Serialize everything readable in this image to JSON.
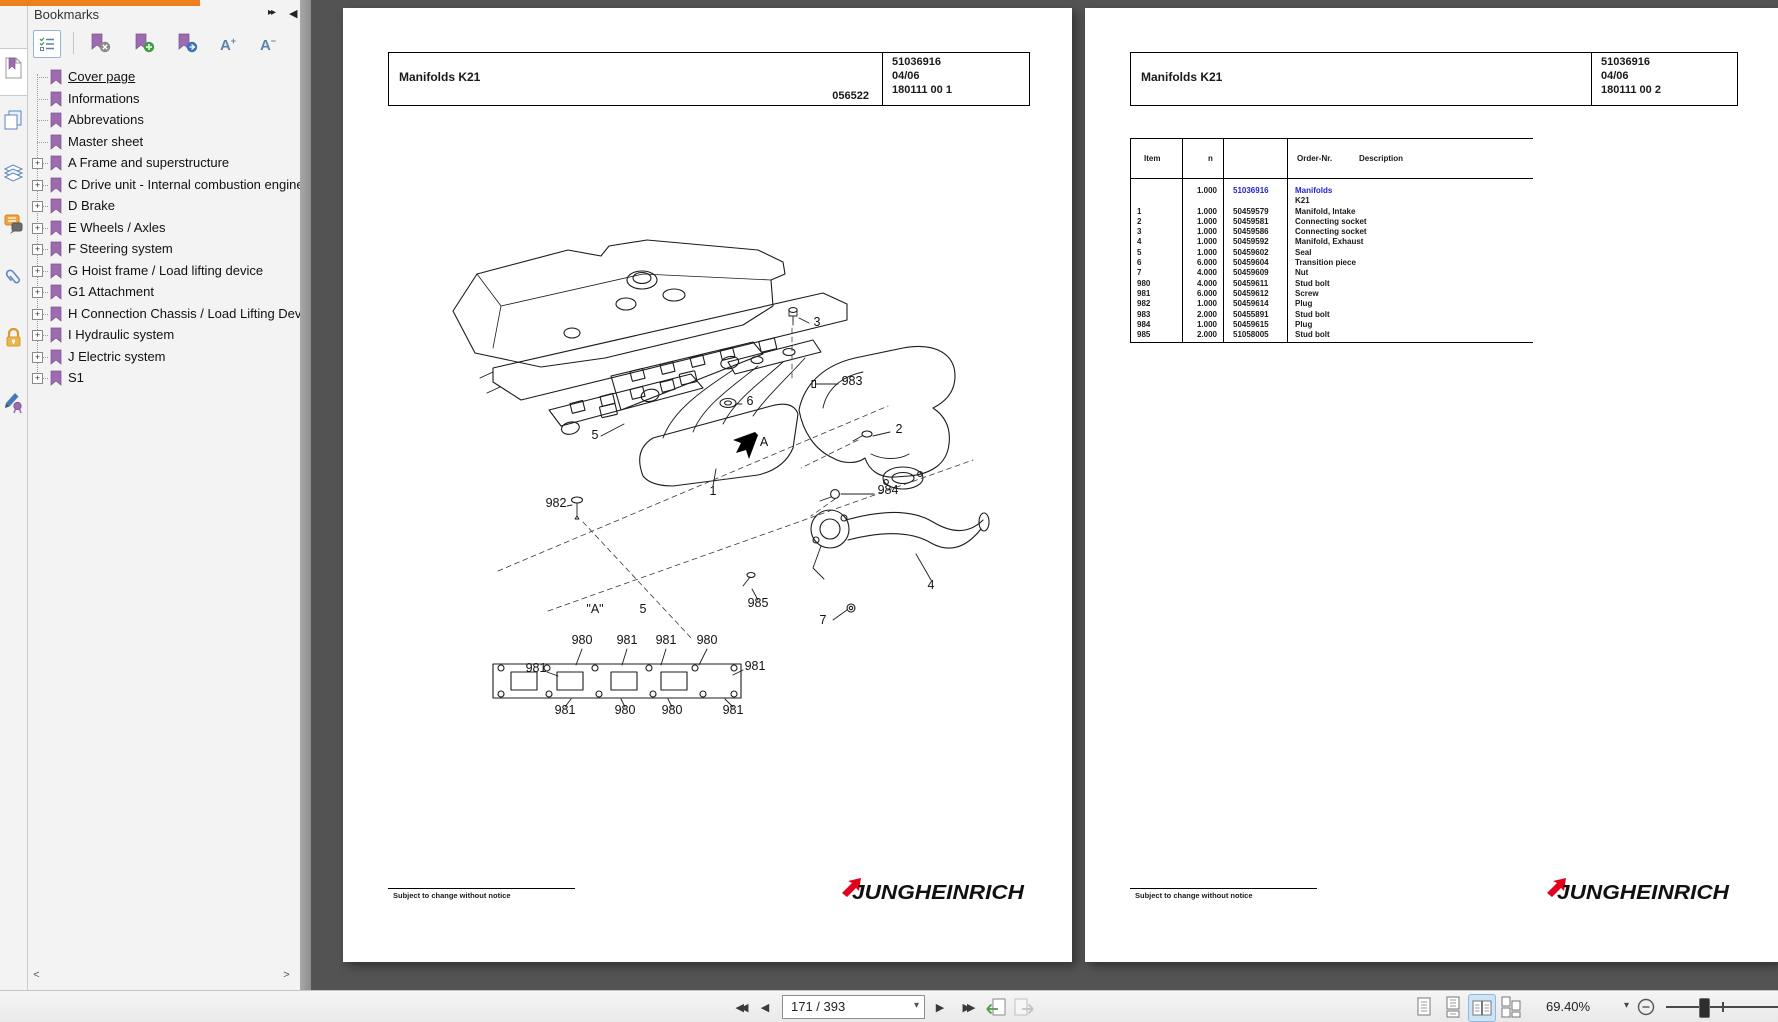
{
  "colors": {
    "accent_orange": "#ee7f1d",
    "bookmark_purple": "#9c6cae",
    "link_blue": "#2424c8",
    "brand_red": "#e2001a",
    "canvas_bg": "#535353",
    "active_view_bg": "#cde3f6"
  },
  "icons": {
    "panel_collapse": "▸▸",
    "panel_hide": "◀",
    "expander": "+",
    "scroll_left": "<",
    "scroll_right": ">",
    "nav_first": "◀◀",
    "nav_prev": "◀",
    "nav_next": "▶",
    "nav_last": "▶▶",
    "combo_caret": "▾",
    "zoom_caret": "▾"
  },
  "bookmarks_panel": {
    "title": "Bookmarks",
    "items": [
      {
        "label": "Cover page",
        "expandable": false,
        "active": true
      },
      {
        "label": "Informations",
        "expandable": false
      },
      {
        "label": "Abbrevations",
        "expandable": false
      },
      {
        "label": "Master sheet",
        "expandable": false
      },
      {
        "label": "A Frame and superstructure",
        "expandable": true
      },
      {
        "label": "C Drive unit - Internal combustion engine",
        "expandable": true
      },
      {
        "label": "D Brake",
        "expandable": true
      },
      {
        "label": "E Wheels / Axles",
        "expandable": true
      },
      {
        "label": "F Steering system",
        "expandable": true
      },
      {
        "label": "G Hoist frame / Load lifting device",
        "expandable": true
      },
      {
        "label": "G1 Attachment",
        "expandable": true
      },
      {
        "label": "H Connection Chassis / Load Lifting Device",
        "expandable": true
      },
      {
        "label": "I Hydraulic system",
        "expandable": true
      },
      {
        "label": "J Electric system",
        "expandable": true
      },
      {
        "label": "S1",
        "expandable": true
      }
    ]
  },
  "left_page": {
    "header": {
      "title": "Manifolds K21",
      "code": "056522",
      "order_no": "51036916",
      "date": "04/06",
      "sheet": "180111 00 1"
    },
    "footer_note": "Subject to change without notice",
    "brand": "JUNGHEINRICH",
    "diagram": {
      "callouts": [
        {
          "t": "3",
          "x": 474,
          "y": 318
        },
        {
          "t": "983",
          "x": 509,
          "y": 377
        },
        {
          "t": "6",
          "x": 407,
          "y": 397
        },
        {
          "t": "2",
          "x": 556,
          "y": 425
        },
        {
          "t": "A",
          "x": 421,
          "y": 438
        },
        {
          "t": "5",
          "x": 252,
          "y": 431
        },
        {
          "t": "1",
          "x": 370,
          "y": 487
        },
        {
          "t": "984",
          "x": 545,
          "y": 486
        },
        {
          "t": "982",
          "x": 213,
          "y": 499
        },
        {
          "t": "985",
          "x": 415,
          "y": 599
        },
        {
          "t": "7",
          "x": 480,
          "y": 616
        },
        {
          "t": "4",
          "x": 588,
          "y": 581
        },
        {
          "t": "\"A\"",
          "x": 252,
          "y": 605
        },
        {
          "t": "5",
          "x": 300,
          "y": 605
        },
        {
          "t": "980",
          "x": 239,
          "y": 636
        },
        {
          "t": "981",
          "x": 284,
          "y": 636
        },
        {
          "t": "981",
          "x": 323,
          "y": 636
        },
        {
          "t": "980",
          "x": 364,
          "y": 636
        },
        {
          "t": "981",
          "x": 193,
          "y": 664
        },
        {
          "t": "981",
          "x": 412,
          "y": 662
        },
        {
          "t": "981",
          "x": 222,
          "y": 706
        },
        {
          "t": "980",
          "x": 282,
          "y": 706
        },
        {
          "t": "980",
          "x": 329,
          "y": 706
        },
        {
          "t": "981",
          "x": 390,
          "y": 706
        }
      ]
    }
  },
  "right_page": {
    "header": {
      "title": "Manifolds K21",
      "order_no": "51036916",
      "date": "04/06",
      "sheet": "180111 00 2"
    },
    "parts_table": {
      "columns": [
        "Item",
        "n",
        "Order-Nr.",
        "Description"
      ],
      "rows": [
        {
          "item": "",
          "n": "1.000",
          "order_nr": "51036916",
          "description": "Manifolds",
          "link": true
        },
        {
          "item": "",
          "n": "",
          "order_nr": "",
          "description": "K21"
        },
        {
          "item": "1",
          "n": "1.000",
          "order_nr": "50459579",
          "description": "Manifold, Intake"
        },
        {
          "item": "2",
          "n": "1.000",
          "order_nr": "50459581",
          "description": "Connecting socket"
        },
        {
          "item": "3",
          "n": "1.000",
          "order_nr": "50459586",
          "description": "Connecting socket"
        },
        {
          "item": "4",
          "n": "1.000",
          "order_nr": "50459592",
          "description": "Manifold, Exhaust"
        },
        {
          "item": "5",
          "n": "1.000",
          "order_nr": "50459602",
          "description": "Seal"
        },
        {
          "item": "6",
          "n": "6.000",
          "order_nr": "50459604",
          "description": "Transition piece"
        },
        {
          "item": "7",
          "n": "4.000",
          "order_nr": "50459609",
          "description": "Nut"
        },
        {
          "item": "980",
          "n": "4.000",
          "order_nr": "50459611",
          "description": "Stud bolt"
        },
        {
          "item": "981",
          "n": "6.000",
          "order_nr": "50459612",
          "description": "Screw"
        },
        {
          "item": "982",
          "n": "1.000",
          "order_nr": "50459614",
          "description": "Plug"
        },
        {
          "item": "983",
          "n": "2.000",
          "order_nr": "50455891",
          "description": "Stud bolt"
        },
        {
          "item": "984",
          "n": "1.000",
          "order_nr": "50459615",
          "description": "Plug"
        },
        {
          "item": "985",
          "n": "2.000",
          "order_nr": "51058005",
          "description": "Stud bolt"
        }
      ]
    },
    "footer_note": "Subject to change without notice",
    "brand": "JUNGHEINRICH"
  },
  "status_bar": {
    "page_indicator": "171 / 393",
    "zoom_level": "69.40%"
  }
}
